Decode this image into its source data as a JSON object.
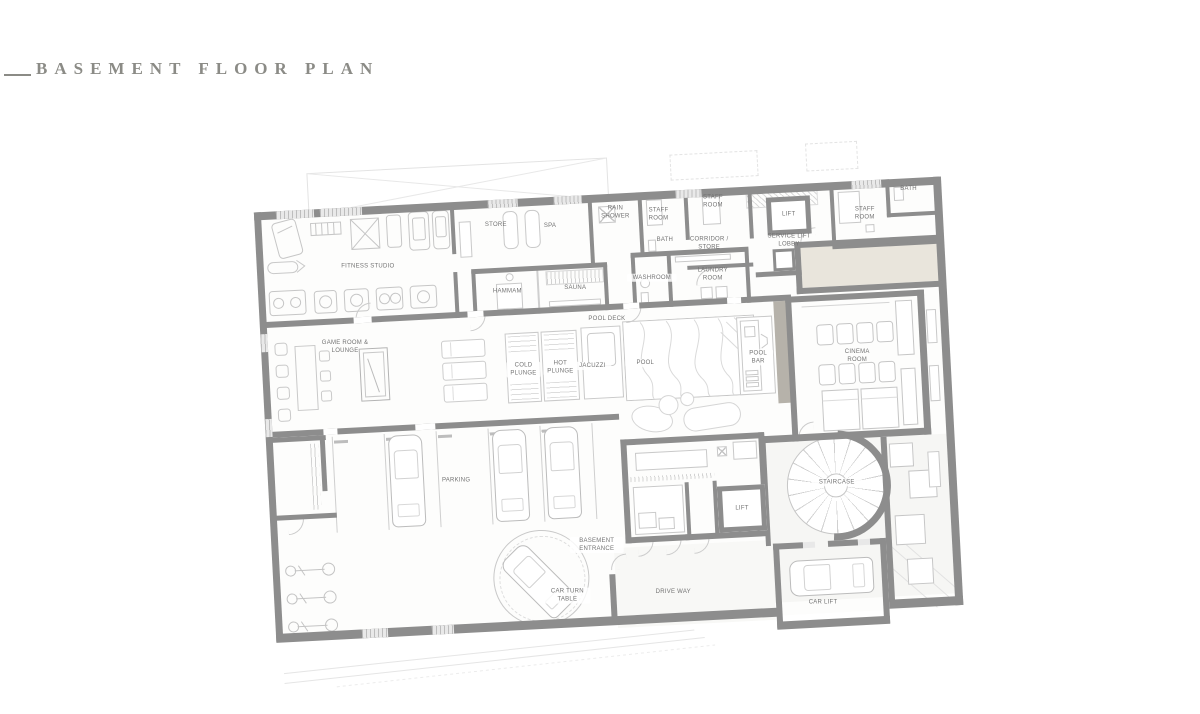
{
  "title": {
    "text": "BASEMENT FLOOR PLAN"
  },
  "labels": {
    "fitness_studio": "FITNESS STUDIO",
    "store": "STORE",
    "spa": "SPA",
    "rain_shower": "RAIN SHOWER",
    "staff_room_1": "STAFF ROOM",
    "bath_1": "BATH",
    "staff_room_2": "STAFF ROOM",
    "corridor_store": "CORRIDOR / STORE",
    "lift_top": "LIFT",
    "service_lift_lobby": "SERVICE LIFT LOBBY",
    "staff_room_3": "STAFF ROOM",
    "bath_2": "BATH",
    "hammam": "HAMMAM",
    "sauna": "SAUNA",
    "washroom": "WASHROOM",
    "laundry_room": "LAUNDRY ROOM",
    "game_room_lounge": "GAME ROOM & LOUNGE",
    "pool_deck": "POOL DECK",
    "cold_plunge": "COLD PLUNGE",
    "hot_plunge": "HOT PLUNGE",
    "jacuzzi": "JACUZZI",
    "pool": "POOL",
    "pool_bar": "POOL BAR",
    "cinema_room": "CINEMA ROOM",
    "parking": "PARKING",
    "basement_entrance": "BASEMENT ENTRANCE",
    "car_turn_table": "CAR TURN TABLE",
    "drive_way": "DRIVE WAY",
    "lift_bottom": "LIFT",
    "staircase": "STAIRCASE",
    "car_lift": "CAR LIFT"
  },
  "colors": {
    "wall": "#8d8d8d",
    "furniture_line": "#c9c9c9",
    "beige_zone": "#e9e5dc",
    "title_text": "#8b8b86",
    "room_label": "#737373",
    "background": "#ffffff"
  }
}
